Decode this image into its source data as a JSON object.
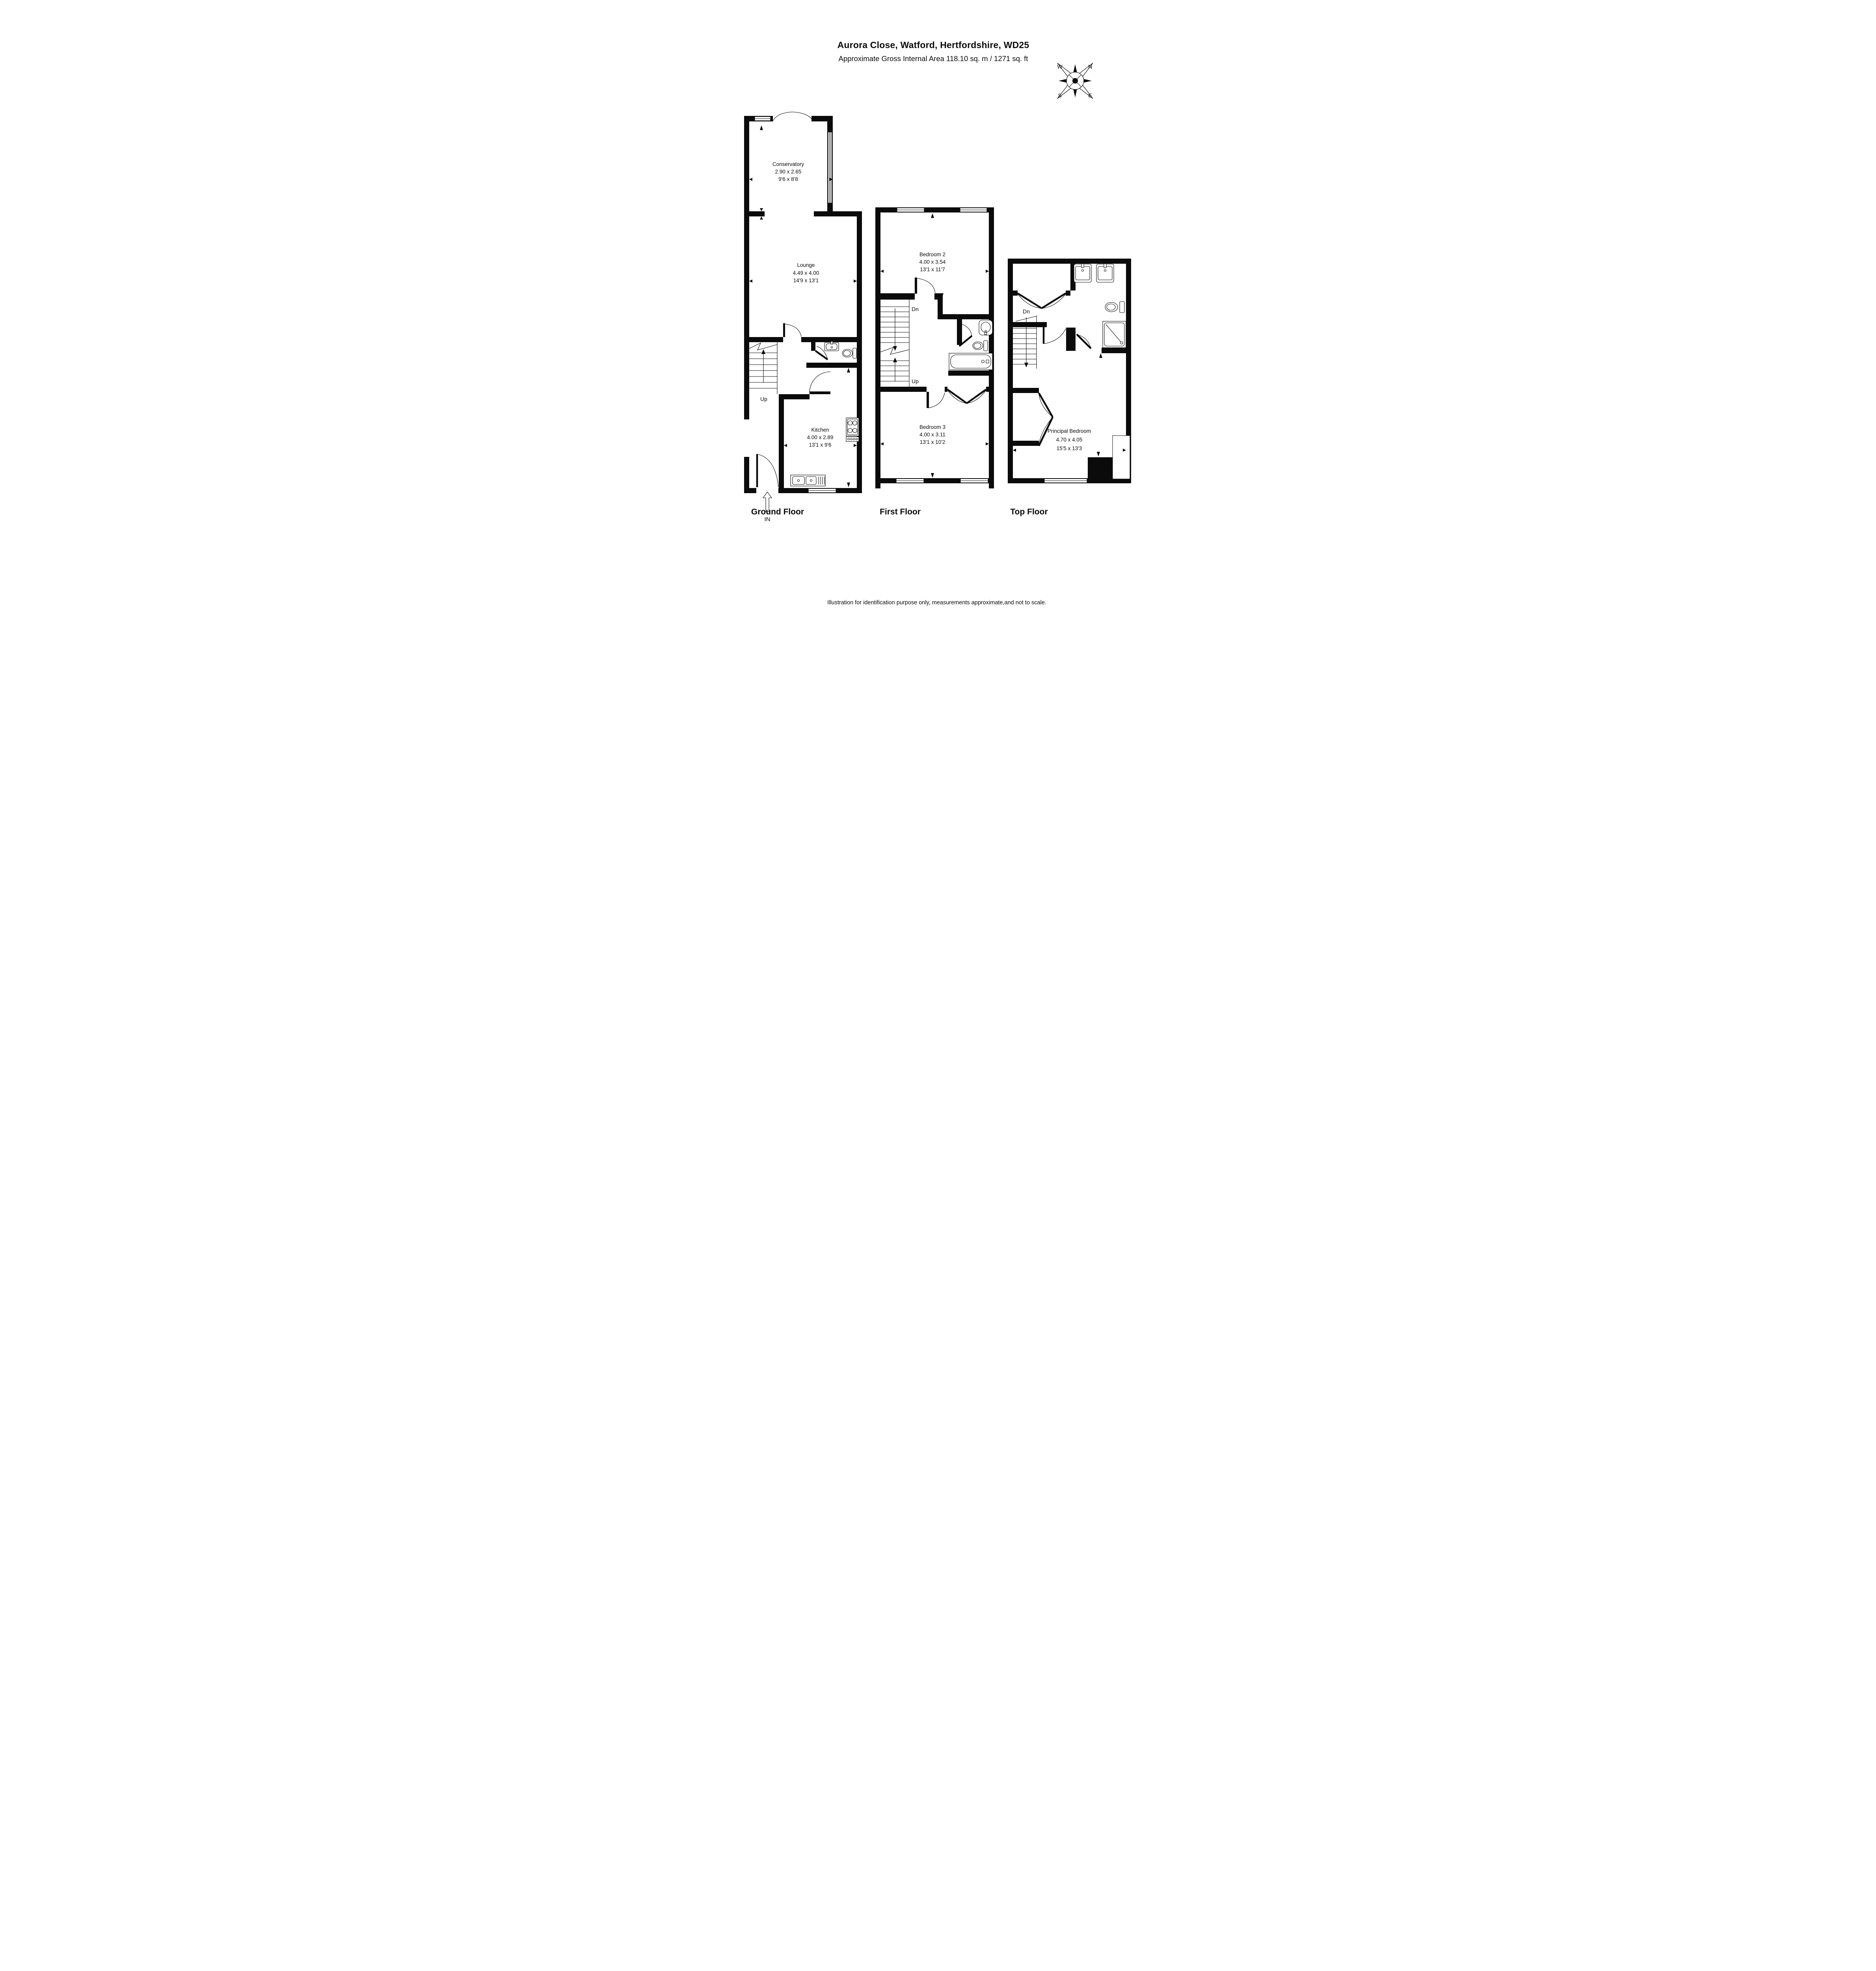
{
  "header": {
    "title": "Aurora Close, Watford, Hertfordshire, WD25",
    "subtitle": "Approximate Gross Internal Area 118.10 sq. m / 1271 sq. ft"
  },
  "compass": {
    "north": "N",
    "east": "E",
    "south": "S",
    "west": "W"
  },
  "floors": {
    "ground": {
      "label": "Ground Floor",
      "stairs": {
        "up": "Up"
      },
      "entrance": {
        "label": "IN"
      },
      "rooms": {
        "conservatory": {
          "name": "Conservatory",
          "metric": "2.90 x 2.65",
          "imperial": "9'6 x 8'8"
        },
        "lounge": {
          "name": "Lounge",
          "metric": "4.49 x 4.00",
          "imperial": "14'9 x 13'1"
        },
        "kitchen": {
          "name": "Kitchen",
          "metric": "4.00 x 2.89",
          "imperial": "13'1 x 9'6"
        }
      }
    },
    "first": {
      "label": "First Floor",
      "stairs": {
        "up": "Up",
        "down": "Dn"
      },
      "rooms": {
        "bedroom2": {
          "name": "Bedroom 2",
          "metric": "4.00 x 3.54",
          "imperial": "13'1 x 11'7"
        },
        "bedroom3": {
          "name": "Bedroom 3",
          "metric": "4.00 x 3.11",
          "imperial": "13'1 x 10'2"
        }
      }
    },
    "top": {
      "label": "Top Floor",
      "stairs": {
        "down": "Dn"
      },
      "rooms": {
        "principal": {
          "name": "Principal Bedroom",
          "metric": "4.70 x 4.05",
          "imperial": "15'5 x 13'3"
        }
      }
    }
  },
  "footer": {
    "disclaimer": "Illustration for identification purpose only, measurements approximate,and not to scale."
  }
}
